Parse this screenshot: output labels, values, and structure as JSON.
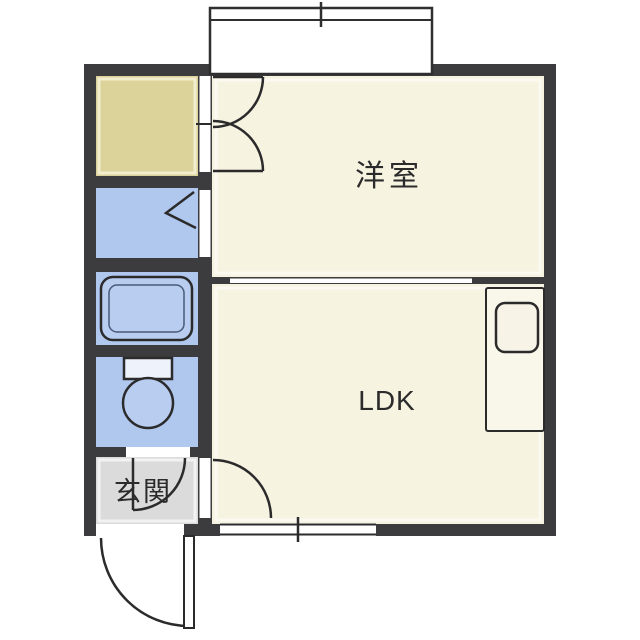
{
  "plan": {
    "kind": "apartment-floor-plan"
  },
  "rooms": {
    "western_room": {
      "label": "洋室"
    },
    "ldk": {
      "label": "LDK"
    },
    "entrance": {
      "label": "玄関"
    }
  },
  "colors": {
    "background": "#ffffff",
    "wall": "#3c3c3e",
    "room_floor": "#f7f3e1",
    "closet_floor": "#dcd39b",
    "wet_area_floor": "#b0c7ee",
    "entrance_floor": "#dbdbdb",
    "line": "#2b2b2b",
    "fixture_fill": "#ffffff"
  },
  "icons": {
    "bathtub": "bathtub-icon",
    "toilet": "toilet-icon",
    "kitchen_sink": "kitchen-sink-icon",
    "balcony_window": "balcony-window-icon",
    "swing_door": "door-swing-icon",
    "folding_door": "folding-door-icon",
    "sliding_partition": "sliding-door-icon",
    "window": "window-icon"
  }
}
